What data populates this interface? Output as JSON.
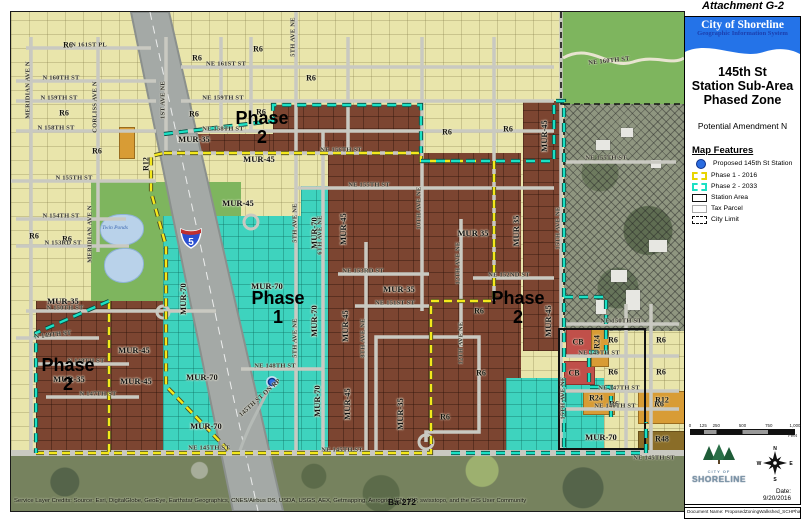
{
  "attachment": "Attachment G-2",
  "panel": {
    "org": "City of Shoreline",
    "org_sub": "Geographic Information System",
    "title_line1": "145th St",
    "title_line2": "Station Sub-Area",
    "title_line3": "Phased Zone",
    "subtitle": "Potential Amendment N",
    "legend_title": "Map Features",
    "legend": [
      {
        "type": "station-dot",
        "label": "Proposed 145th St Station",
        "color": "#2a6ce0"
      },
      {
        "type": "phase1",
        "label": "Phase 1 - 2016",
        "color": "#e8d400"
      },
      {
        "type": "phase2",
        "label": "Phase 2 - 2033",
        "color": "#1ce0c4"
      },
      {
        "type": "station-area",
        "label": "Station Area",
        "color": "#111111"
      },
      {
        "type": "tax-parcel",
        "label": "Tax Parcel",
        "color": "#aaaaaa"
      },
      {
        "type": "city-limit",
        "label": "City Limit",
        "color": "#111111"
      }
    ],
    "scale_ticks": [
      "0",
      "125",
      "250",
      "500",
      "750",
      "1,000"
    ],
    "scale_unit": "Feet",
    "logo_city_of": "CITY OF",
    "logo_name": "SHORELINE",
    "compass_points": [
      "N",
      "E",
      "S",
      "W"
    ],
    "date": "Date: 9/20/2016",
    "doc_name": "Document Name: ProposedZoningWalkshed_SCHPhased"
  },
  "map": {
    "credits": "Service Layer Credits: Source: Esri, DigitalGlobe, GeoEye, Earthstar Geographics, CNES/Airbus DS, USDA, USGS, AEX, Getmapping, Aerogrid, IGN, IGP, swisstopo, and the GIS User Community",
    "sheet_label": "Ba-272",
    "pond_label": "Twin Ponds",
    "interstate_shield": "5",
    "colors": {
      "zone_r6_yellow": "#e9e5ab",
      "zone_mur_brown": "#7c4531",
      "zone_mur70_teal": "#3ed3be",
      "park_green": "#7eb55e",
      "phase1_boundary": "#f4e81c",
      "phase2_boundary": "#1ce0c4",
      "station_dot": "#2a6ce0",
      "banner_blue": "#2473e8"
    },
    "phase_labels": [
      {
        "l1": "Phase",
        "l2": "2",
        "x": 251,
        "y": 97
      },
      {
        "l1": "Phase",
        "l2": "1",
        "x": 267,
        "y": 277
      },
      {
        "l1": "Phase",
        "l2": "2",
        "x": 507,
        "y": 277
      },
      {
        "l1": "Phase",
        "l2": "2",
        "x": 57,
        "y": 344
      }
    ],
    "zones": [
      {
        "c": "park",
        "x": 80,
        "y": 170,
        "w": 150,
        "h": 140
      },
      {
        "c": "park",
        "x": 550,
        "y": 0,
        "w": 123,
        "h": 92
      },
      {
        "c": "park",
        "x": 355,
        "y": 181,
        "w": 52,
        "h": 66
      },
      {
        "c": "park",
        "x": 428,
        "y": 349,
        "w": 57,
        "h": 53
      },
      {
        "c": "park",
        "x": 658,
        "y": 160,
        "w": 15,
        "h": 145
      },
      {
        "c": "brown",
        "x": 153,
        "y": 122,
        "w": 110,
        "h": 19
      },
      {
        "c": "brown",
        "x": 262,
        "y": 93,
        "w": 148,
        "h": 48
      },
      {
        "c": "brown",
        "x": 317,
        "y": 129,
        "w": 28,
        "h": 312
      },
      {
        "c": "brown",
        "x": 342,
        "y": 141,
        "w": 168,
        "h": 300
      },
      {
        "c": "brown",
        "x": 512,
        "y": 89,
        "w": 38,
        "h": 250
      },
      {
        "c": "brown",
        "x": 25,
        "y": 289,
        "w": 270,
        "h": 152
      },
      {
        "c": "teal",
        "x": 152,
        "y": 204,
        "w": 138,
        "h": 237
      },
      {
        "c": "teal",
        "x": 290,
        "y": 174,
        "w": 27,
        "h": 267
      },
      {
        "c": "teal",
        "x": 495,
        "y": 366,
        "w": 140,
        "h": 75
      },
      {
        "c": "hatch",
        "x": 553,
        "y": 92,
        "w": 120,
        "h": 230
      },
      {
        "c": "ylw",
        "x": 593,
        "y": 319,
        "w": 80,
        "h": 122
      },
      {
        "c": "orange",
        "x": 108,
        "y": 115,
        "w": 14,
        "h": 30
      },
      {
        "c": "red",
        "x": 555,
        "y": 317,
        "w": 28,
        "h": 24
      },
      {
        "c": "red",
        "x": 553,
        "y": 349,
        "w": 29,
        "h": 22
      },
      {
        "c": "orange",
        "x": 580,
        "y": 317,
        "w": 16,
        "h": 36
      },
      {
        "c": "orange",
        "x": 572,
        "y": 379,
        "w": 30,
        "h": 22
      },
      {
        "c": "orange",
        "x": 627,
        "y": 379,
        "w": 53,
        "h": 31
      },
      {
        "c": "dky",
        "x": 627,
        "y": 419,
        "w": 53,
        "h": 28
      },
      {
        "c": "aerial",
        "x": 0,
        "y": 441,
        "w": 673,
        "h": 58
      }
    ],
    "ponds": [
      {
        "x": 89,
        "y": 202,
        "w": 42,
        "h": 30
      },
      {
        "x": 93,
        "y": 236,
        "w": 38,
        "h": 33
      }
    ],
    "buildings": [
      {
        "x": 585,
        "y": 128,
        "w": 14,
        "h": 10
      },
      {
        "x": 610,
        "y": 116,
        "w": 12,
        "h": 9
      },
      {
        "x": 640,
        "y": 148,
        "w": 10,
        "h": 8
      },
      {
        "x": 600,
        "y": 258,
        "w": 16,
        "h": 12
      },
      {
        "x": 615,
        "y": 278,
        "w": 14,
        "h": 20
      },
      {
        "x": 585,
        "y": 288,
        "w": 10,
        "h": 14
      },
      {
        "x": 638,
        "y": 228,
        "w": 18,
        "h": 12
      }
    ],
    "freeway_points": "120,0 158,0 272,499 222,499",
    "streets_h": [
      [
        36,
        15,
        140
      ],
      [
        55,
        170,
        543
      ],
      [
        69,
        5,
        145
      ],
      [
        89,
        5,
        145
      ],
      [
        89,
        170,
        543
      ],
      [
        119,
        5,
        145
      ],
      [
        119,
        170,
        543
      ],
      [
        141,
        155,
        408
      ],
      [
        150,
        555,
        665
      ],
      [
        169,
        0,
        145
      ],
      [
        176,
        287,
        543
      ],
      [
        207,
        5,
        115
      ],
      [
        234,
        5,
        118
      ],
      [
        262,
        327,
        418
      ],
      [
        266,
        462,
        543
      ],
      [
        294,
        344,
        418
      ],
      [
        299,
        15,
        205
      ],
      [
        312,
        555,
        668
      ],
      [
        326,
        5,
        88
      ],
      [
        344,
        555,
        668
      ],
      [
        352,
        25,
        118
      ],
      [
        357,
        230,
        312
      ],
      [
        379,
        555,
        668
      ],
      [
        385,
        35,
        128
      ],
      [
        397,
        555,
        668
      ],
      [
        441,
        0,
        673
      ]
    ],
    "streets_v": [
      [
        20,
        25,
        441
      ],
      [
        87,
        25,
        240
      ],
      [
        155,
        25,
        141
      ],
      [
        210,
        25,
        119
      ],
      [
        240,
        25,
        119
      ],
      [
        285,
        0,
        441
      ],
      [
        312,
        119,
        441
      ],
      [
        337,
        25,
        141
      ],
      [
        355,
        230,
        441
      ],
      [
        411,
        25,
        299
      ],
      [
        450,
        207,
        335
      ],
      [
        483,
        25,
        289
      ],
      [
        550,
        0,
        441
      ],
      [
        615,
        292,
        441
      ],
      [
        640,
        292,
        441
      ]
    ],
    "boundary_phase1": "M153,141 L410,141 L410,149 L483,149 L483,289 L420,289 L420,441 L220,441 L155,374 L155,234 L140,180 L140,144 Z M98,289 L98,441 M25,441 L220,441",
    "boundary_phase2": "M153,122 L262,109 L262,93 L410,93 L410,141 M410,149 L543,149 L543,89 L553,89 L553,441 M440,441 L635,441 L635,410 M98,289 L25,321 L25,441 M553,285 L595,285 L595,340 L578,340 L578,375 L600,375 L600,405",
    "boundary_citylimit": "M550,0 L550,92 L553,92 L553,319 M553,92 L673,92",
    "station_area_rect": {
      "x": 548,
      "y": 317,
      "w": 86,
      "h": 120
    },
    "station_dot": {
      "x": 261,
      "y": 370
    },
    "shield": {
      "x": 180,
      "y": 225
    },
    "winding_road": "M552,46 C 580,30 598,58 622,50 C 645,42 660,54 673,46",
    "loop_road": "M365,441 L365,325 L468,325 L468,420 L415,420 L415,430",
    "culdesacs": [
      [
        240,
        210,
        7
      ],
      [
        415,
        430,
        7
      ],
      [
        152,
        300,
        6
      ]
    ],
    "ramp_road": "M228,441 C 238,412 248,398 262,368",
    "zone_labels": [
      [
        "MUR-35",
        183,
        127,
        0
      ],
      [
        "MUR-35",
        52,
        289,
        0
      ],
      [
        "MUR-35",
        58,
        367,
        0
      ],
      [
        "MUR 35",
        462,
        221,
        0
      ],
      [
        "MUR-35",
        388,
        277,
        0
      ],
      [
        "MUR 35",
        505,
        219,
        -90
      ],
      [
        "MUR-35",
        389,
        402,
        -90
      ],
      [
        "MUR-45",
        248,
        147,
        0
      ],
      [
        "MUR-45",
        227,
        191,
        0
      ],
      [
        "MUR-45",
        123,
        338,
        0
      ],
      [
        "MUR-45",
        125,
        369,
        0
      ],
      [
        "MUR-45",
        332,
        217,
        -90
      ],
      [
        "MUR-45",
        334,
        314,
        -90
      ],
      [
        "MUR-45",
        336,
        392,
        -90
      ],
      [
        "MUR-45",
        533,
        124,
        -90
      ],
      [
        "MUR-45",
        537,
        309,
        -90
      ],
      [
        "MUR-70",
        256,
        274,
        0
      ],
      [
        "MUR-70",
        191,
        365,
        0
      ],
      [
        "MUR-70",
        195,
        414,
        0
      ],
      [
        "MUR-70",
        590,
        425,
        0
      ],
      [
        "MUR-70",
        172,
        287,
        -90
      ],
      [
        "MUR-70",
        303,
        221,
        -90
      ],
      [
        "MUR-70",
        303,
        309,
        -90
      ],
      [
        "MUR-70",
        306,
        389,
        -90
      ]
    ],
    "parcel_labels": [
      [
        "R6",
        57,
        33
      ],
      [
        "R6",
        53,
        101
      ],
      [
        "R6",
        86,
        139
      ],
      [
        "R6",
        186,
        46
      ],
      [
        "R6",
        247,
        37
      ],
      [
        "R6",
        183,
        102
      ],
      [
        "R6",
        250,
        100
      ],
      [
        "R6",
        300,
        66
      ],
      [
        "R6",
        436,
        120
      ],
      [
        "R6",
        497,
        117
      ],
      [
        "R6",
        23,
        224
      ],
      [
        "R6",
        56,
        227
      ],
      [
        "R6",
        468,
        299
      ],
      [
        "R6",
        470,
        361
      ],
      [
        "R6",
        434,
        405
      ],
      [
        "R6",
        602,
        328
      ],
      [
        "R6",
        650,
        328
      ],
      [
        "R6",
        602,
        360
      ],
      [
        "R6",
        650,
        360
      ],
      [
        "R6",
        603,
        392
      ],
      [
        "R6",
        648,
        392
      ],
      [
        "R12",
        135,
        152,
        -90
      ],
      [
        "R12",
        651,
        388
      ],
      [
        "R24",
        586,
        330,
        -90
      ],
      [
        "R24",
        585,
        386
      ],
      [
        "R48",
        651,
        427
      ],
      [
        "CB",
        567,
        330
      ],
      [
        "CB",
        563,
        361
      ]
    ],
    "street_labels": [
      [
        "N 161ST PL",
        78,
        33,
        0
      ],
      [
        "NE 161ST ST",
        215,
        52,
        0
      ],
      [
        "N 160TH ST",
        50,
        66,
        0
      ],
      [
        "NE 160TH ST",
        598,
        49,
        -6
      ],
      [
        "N 159TH ST",
        48,
        86,
        0
      ],
      [
        "NE 159TH ST",
        212,
        86,
        0
      ],
      [
        "N 158TH ST",
        45,
        116,
        0
      ],
      [
        "NE 158TH ST",
        212,
        117,
        0
      ],
      [
        "NE 156TH ST",
        330,
        138,
        0
      ],
      [
        "N 155TH ST",
        63,
        166,
        0
      ],
      [
        "NE 155TH ST",
        358,
        173,
        0
      ],
      [
        "NE 155TH ST",
        595,
        146,
        0
      ],
      [
        "N 154TH ST",
        50,
        204,
        0
      ],
      [
        "N 153RD ST",
        52,
        231,
        0
      ],
      [
        "NE 153RD ST",
        352,
        259,
        0
      ],
      [
        "NE 152ND ST",
        498,
        263,
        0
      ],
      [
        "NE 151ST ST",
        384,
        291,
        0
      ],
      [
        "N 150TH ST",
        54,
        296,
        0
      ],
      [
        "NE 150TH ST",
        610,
        309,
        0
      ],
      [
        "N 149TH ST",
        42,
        323,
        -6
      ],
      [
        "NE 149TH ST",
        588,
        341,
        0
      ],
      [
        "N 148TH ST",
        75,
        349,
        0
      ],
      [
        "NE 148TH ST",
        264,
        354,
        0
      ],
      [
        "N 147TH ST",
        87,
        382,
        0
      ],
      [
        "NE 147TH ST",
        608,
        376,
        0
      ],
      [
        "NE 146TH ST",
        604,
        394,
        0
      ],
      [
        "NE 145TH ST",
        198,
        436,
        0
      ],
      [
        "NE 145TH ST",
        331,
        438,
        0
      ],
      [
        "NE 145TH ST",
        643,
        446,
        0
      ],
      [
        "MERIDIAN AVE N",
        17,
        78,
        -90
      ],
      [
        "CORLISS AVE N",
        84,
        95,
        -90
      ],
      [
        "MERIDIAN AVE N",
        79,
        222,
        -90
      ],
      [
        "1ST AVE NE",
        152,
        88,
        -90
      ],
      [
        "5TH AVE NE",
        282,
        25,
        -90
      ],
      [
        "5TH AVE NE",
        284,
        211,
        -90
      ],
      [
        "5TH AVE NE",
        284,
        326,
        -90
      ],
      [
        "6TH AVE NE",
        309,
        223,
        -90
      ],
      [
        "8TH AVE NE",
        352,
        326,
        -90
      ],
      [
        "10TH AVE NE",
        408,
        196,
        -90
      ],
      [
        "12TH AVE NE",
        447,
        251,
        -90
      ],
      [
        "12TH AVE NE",
        450,
        331,
        -90
      ],
      [
        "15TH AVE NE",
        547,
        216,
        -90
      ],
      [
        "15TH AVE NE",
        552,
        386,
        -90
      ],
      [
        "145TH ST ON RP",
        249,
        386,
        -42
      ]
    ],
    "pond_label_pos": {
      "x": 104,
      "y": 216
    },
    "sheet_label_pos": {
      "x": 391,
      "y": 490
    }
  }
}
